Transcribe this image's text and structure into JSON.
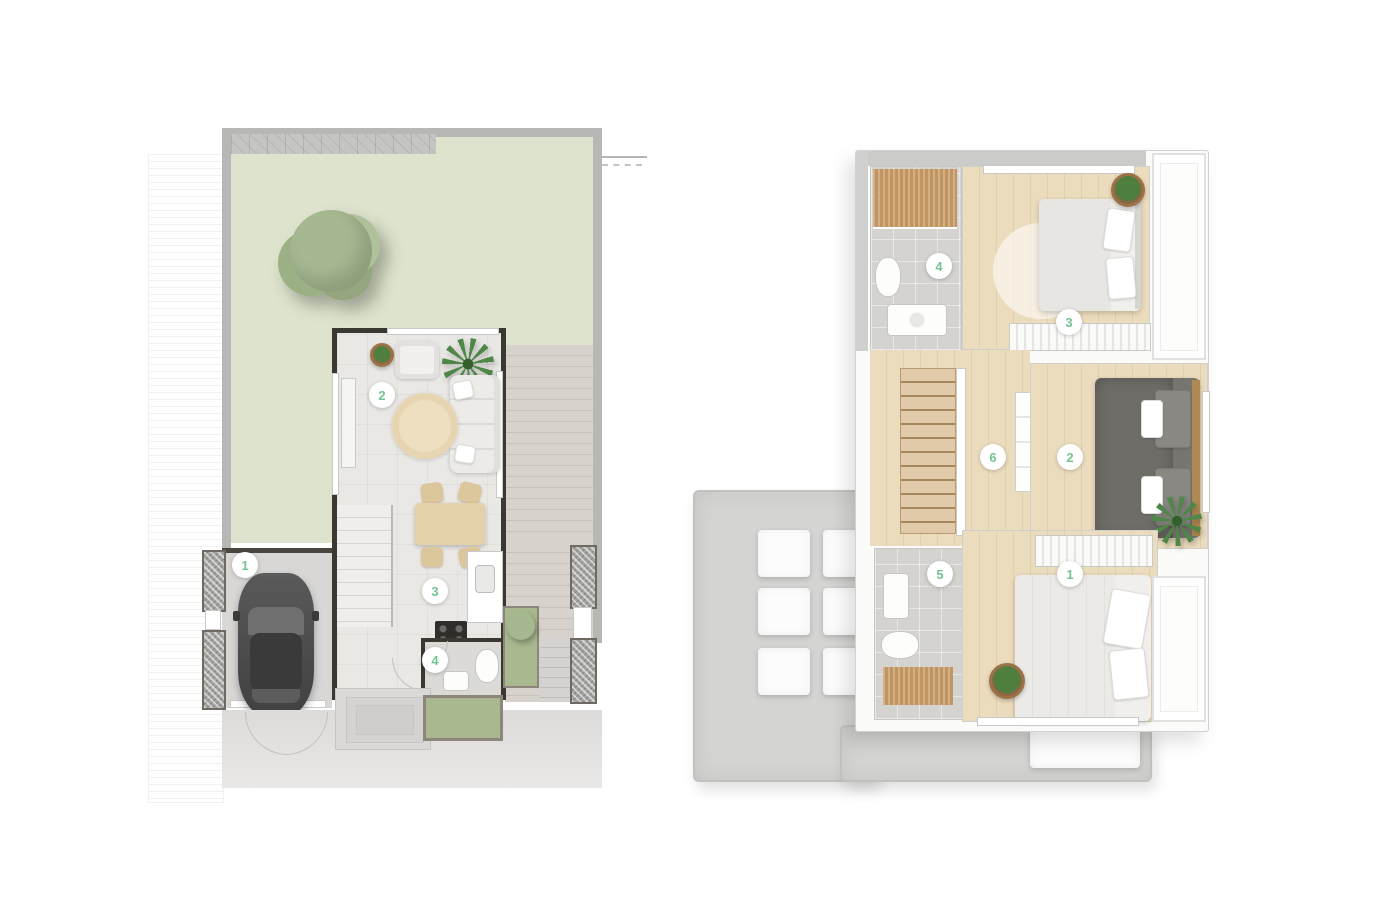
{
  "colors": {
    "marker_green": "#74c493",
    "garden_green": "#dde3cc",
    "tree_green": "#a5b890",
    "deck_gray": "#d7d2cc",
    "deck_line": "#c8c2bc",
    "wood_floor": "#ecdcbe",
    "wood_line": "#e2cfac",
    "slat_wood": "#c2945f",
    "roof_concrete": "#d4d4d2",
    "tile_gray": "#d5d3d0",
    "wall_dark": "#3b3832",
    "concrete": "#cbcbc9",
    "car_gray": "#474747",
    "planter_green": "#a9b88e"
  },
  "ground_floor": {
    "markers": [
      {
        "label": "1"
      },
      {
        "label": "2"
      },
      {
        "label": "3"
      },
      {
        "label": "4"
      }
    ]
  },
  "upper_floor": {
    "markers": [
      {
        "label": "1"
      },
      {
        "label": "2"
      },
      {
        "label": "3"
      },
      {
        "label": "4"
      },
      {
        "label": "5"
      },
      {
        "label": "6"
      }
    ]
  }
}
